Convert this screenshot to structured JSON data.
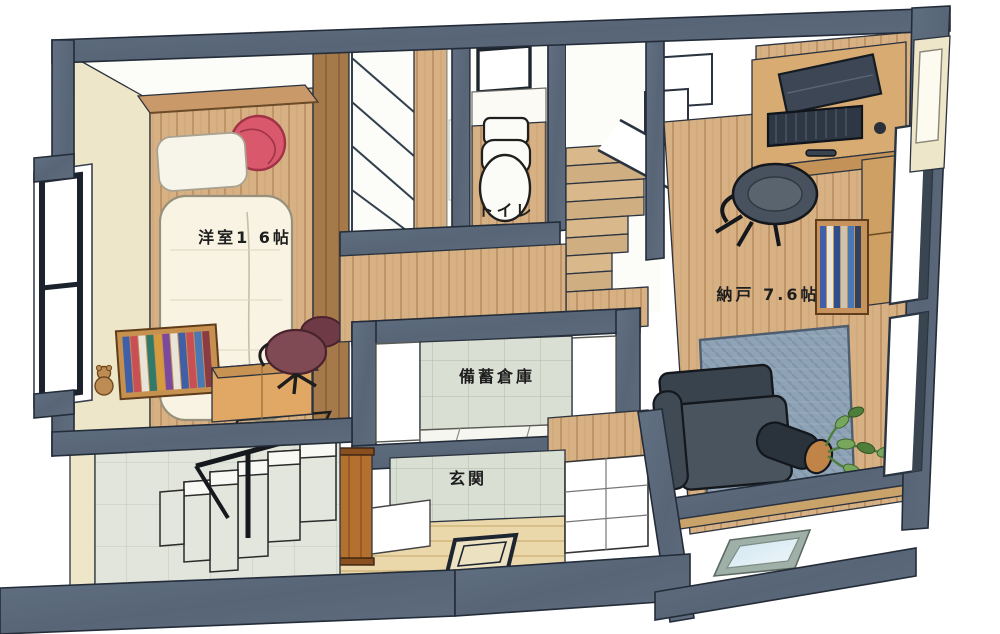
{
  "illustration": {
    "type": "isometric-floor-plan-sketch",
    "rooms": [
      {
        "id": "bedroom",
        "label": "洋室1 6帖"
      },
      {
        "id": "toilet",
        "label": "トイレ"
      },
      {
        "id": "storage-room",
        "label": "納戸 7.6帖"
      },
      {
        "id": "stockpile-storage",
        "label": "備蓄倉庫"
      },
      {
        "id": "entrance",
        "label": "玄関"
      }
    ],
    "furniture": [
      "bed",
      "pillow",
      "round-cushion",
      "headboard-shelf",
      "bookshelf",
      "teddy-bear",
      "study-desk",
      "desk-chair",
      "closet-shelves",
      "toilet-bowl",
      "staircase-up",
      "staircase-down",
      "handrail",
      "work-desk",
      "laptop",
      "document-tray",
      "office-chair",
      "book-rack",
      "area-rug",
      "sofa",
      "planter-pot",
      "houseplant",
      "skylight",
      "floor-hatch",
      "shoe-cabinet",
      "window"
    ],
    "palette": {
      "wall_cut": "#5c6a7b",
      "ink_outline": "#2b333f",
      "wall_cream": "#eee6c9",
      "wood_floor": "#d7b184",
      "wood_dark": "#a6794a",
      "wood_bright": "#b4702f",
      "tile_gray": "#dadfd4",
      "rug_blue": "#8ea3b6",
      "sofa_dark": "#49545f",
      "cushion_red": "#d9586c",
      "chair_maroon": "#804a55",
      "plant_green": "#76a75c",
      "duvet_cream": "#f8f3e3",
      "glass_blue": "#cfe6f2"
    }
  }
}
